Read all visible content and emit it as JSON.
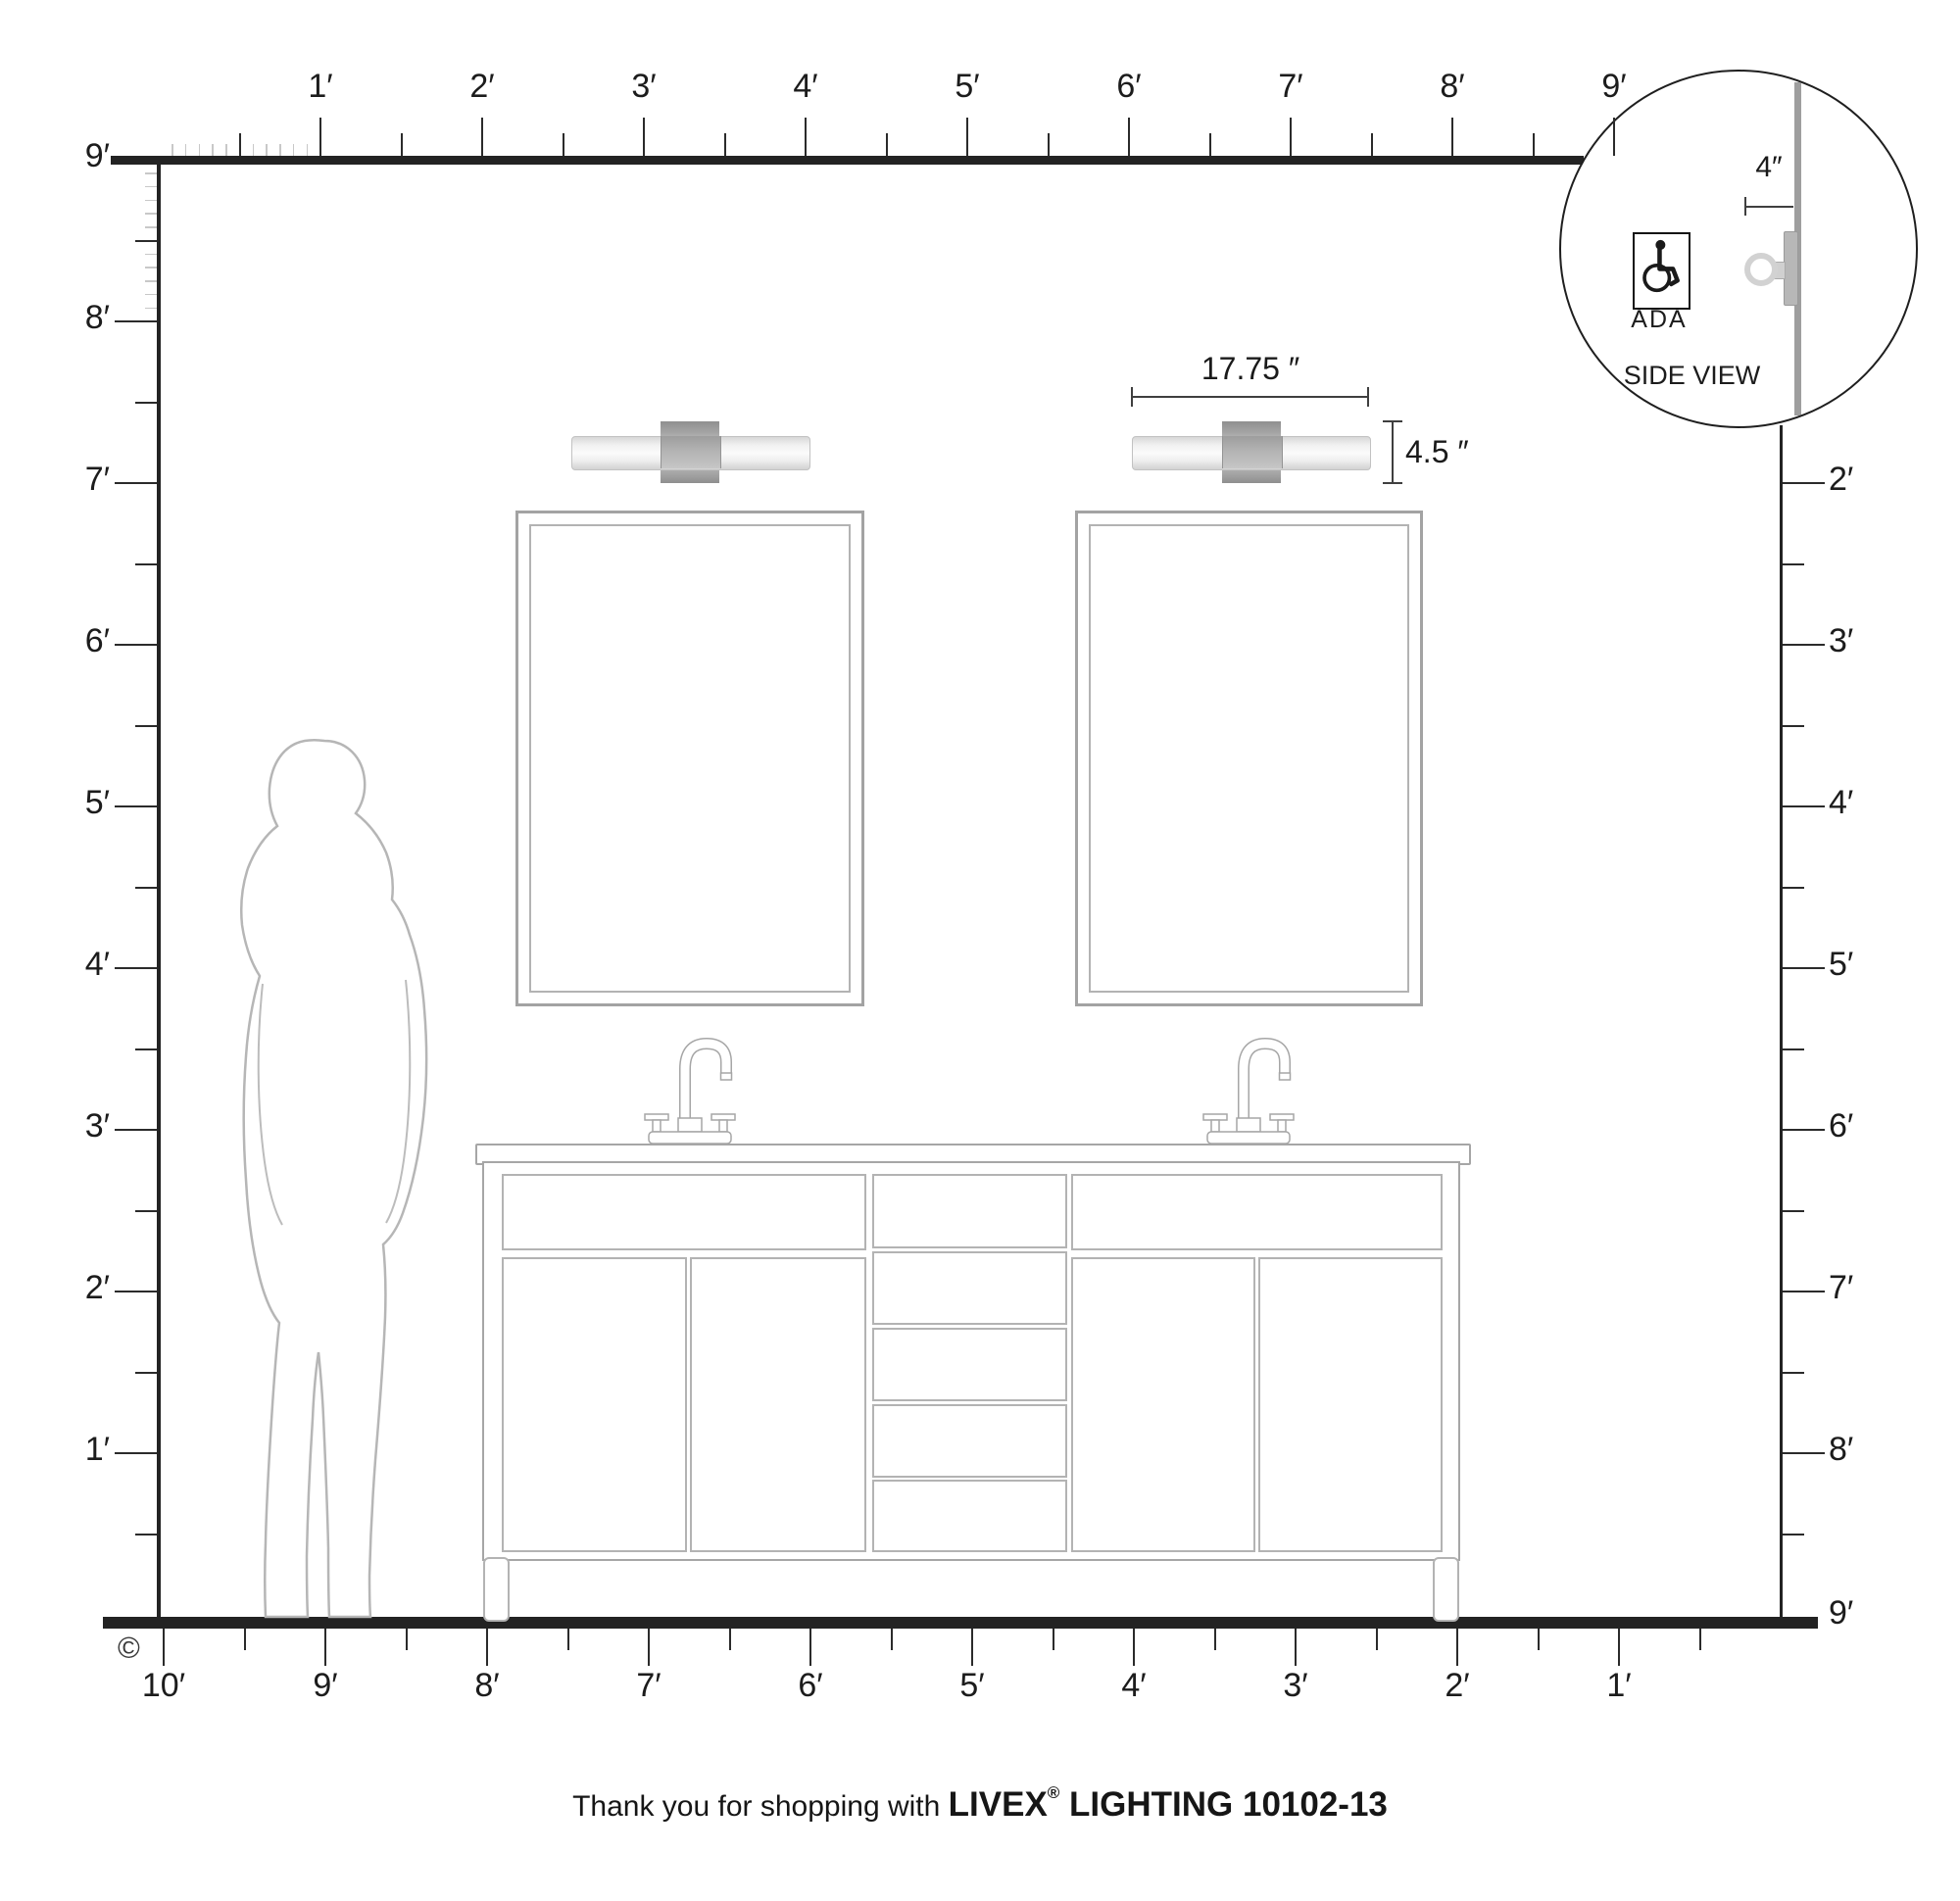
{
  "footer": {
    "prefix": "Thank you for shopping with ",
    "brand": "LIVEX",
    "registered": "®",
    "suffix": " LIGHTING 10102-13"
  },
  "copyright_symbol": "©",
  "side_view_inset": {
    "depth_label": "4″",
    "ada_label": "ADA",
    "caption": "SIDE VIEW"
  },
  "fixture_dimensions": {
    "width_label": "17.75 ″",
    "height_label": "4.5 ″"
  },
  "rulers": {
    "top": [
      "1′",
      "2′",
      "3′",
      "4′",
      "5′",
      "6′",
      "7′",
      "8′",
      "9′"
    ],
    "left": [
      "9′",
      "8′",
      "7′",
      "6′",
      "5′",
      "4′",
      "3′",
      "2′",
      "1′"
    ],
    "right": [
      "2′",
      "3′",
      "4′",
      "5′",
      "6′",
      "7′",
      "8′",
      "9′"
    ],
    "bottom": [
      "10′",
      "9′",
      "8′",
      "7′",
      "6′",
      "5′",
      "4′",
      "3′",
      "2′",
      "1′"
    ]
  },
  "colors": {
    "structure": "#232323",
    "drawing": "#a6a6a6",
    "tick_minor": "#c8c8c8",
    "silhouette": "#b6b6b6"
  }
}
